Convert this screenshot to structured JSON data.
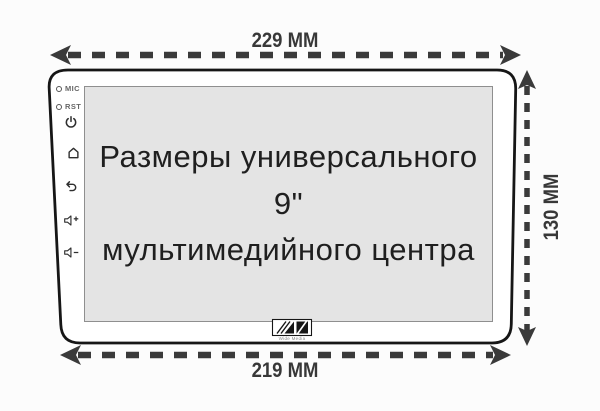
{
  "dimensions": {
    "width_top": "229 MM",
    "width_bottom": "219 MM",
    "height_right": "130 MM"
  },
  "screen_text": {
    "line1": "Размеры универсального 9\"",
    "line2": "мультимедийного центра"
  },
  "side_panel": {
    "mic_label": "MIC",
    "rst_label": "RST",
    "icon_names": [
      "power-icon",
      "home-icon",
      "back-icon",
      "volume-up-icon",
      "volume-down-icon"
    ]
  },
  "logo": {
    "caption": "Wide Media"
  },
  "colors": {
    "arrow": "#3a3a3a",
    "device_outline": "#161616",
    "screen_fill": "#e4e4e4",
    "screen_border": "#8f8f8f",
    "title_text": "#1f1f1f"
  }
}
